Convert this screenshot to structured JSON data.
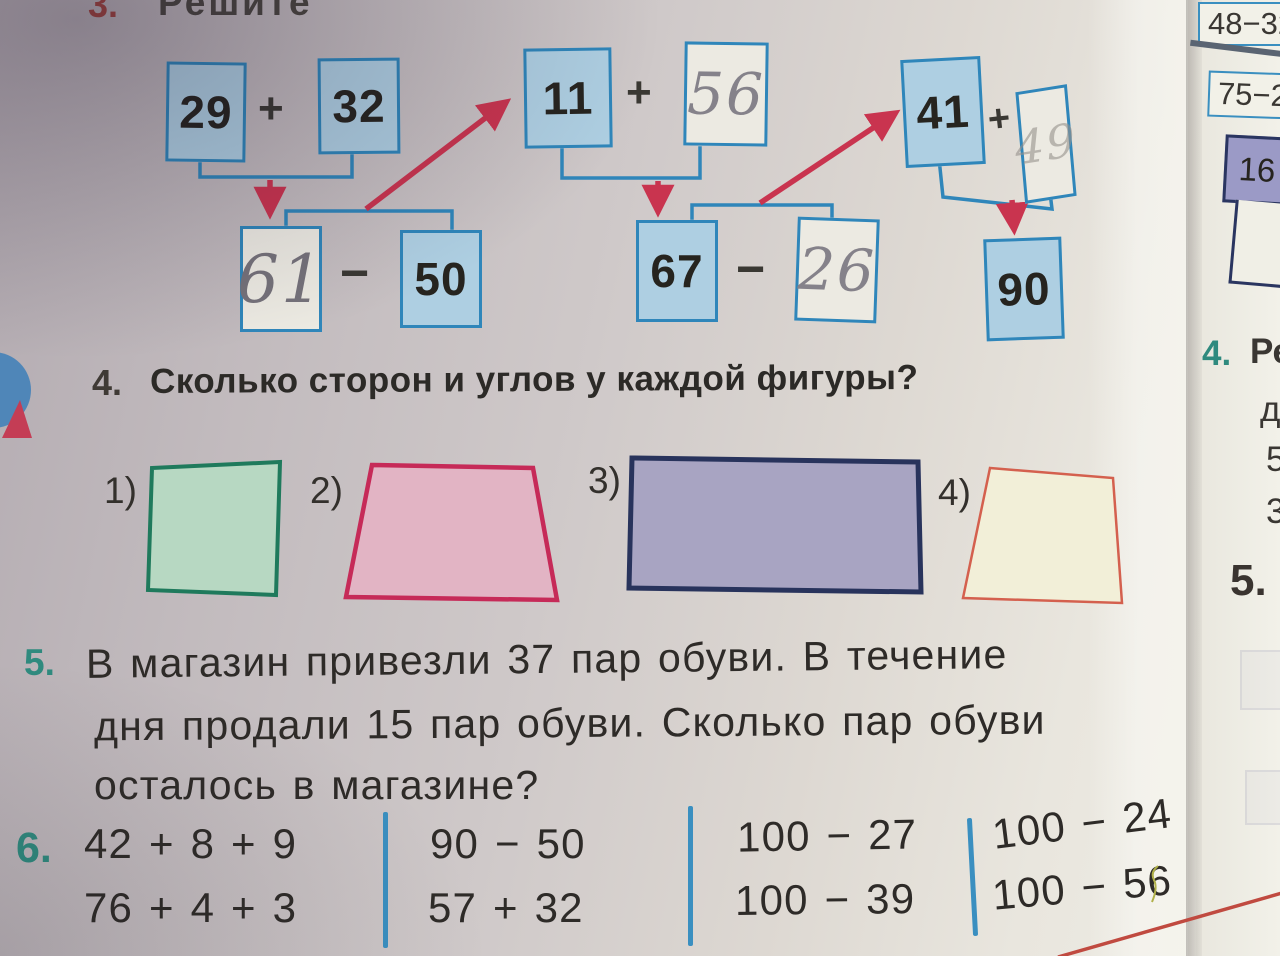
{
  "ex3": {
    "number": "3.",
    "title_fragment": "Решите",
    "boxes": [
      {
        "value": "29",
        "style": "printed"
      },
      {
        "value": "32",
        "style": "printed"
      },
      {
        "value": "61",
        "style": "handwritten"
      },
      {
        "value": "50",
        "style": "printed"
      },
      {
        "value": "11",
        "style": "printed"
      },
      {
        "value": "56",
        "style": "handwritten"
      },
      {
        "value": "67",
        "style": "printed"
      },
      {
        "value": "26",
        "style": "handwritten"
      },
      {
        "value": "41",
        "style": "printed"
      },
      {
        "value": "49",
        "style": "handwritten-faint"
      },
      {
        "value": "90",
        "style": "printed"
      }
    ],
    "operators": [
      "+",
      "−",
      "+",
      "−",
      "+"
    ]
  },
  "ex4": {
    "number": "4.",
    "question": "Сколько сторон и углов у каждой фигуры?",
    "shapes": [
      {
        "label": "1)",
        "kind": "square",
        "fill": "#b7d8c2",
        "stroke": "#1f7a5c"
      },
      {
        "label": "2)",
        "kind": "trapezoid",
        "fill": "#e2b4c4",
        "stroke": "#c62a58"
      },
      {
        "label": "3)",
        "kind": "rectangle",
        "fill": "#a8a4c2",
        "stroke": "#28335c"
      },
      {
        "label": "4)",
        "kind": "trapezoid",
        "fill": "#f2efd8",
        "stroke": "#d4604e"
      }
    ]
  },
  "ex5": {
    "number": "5.",
    "line1": "В магазин привезли 37 пар обуви. В течение",
    "line2": "дня продали 15 пар обуви. Сколько пар обуви",
    "line3": "осталось в магазине?"
  },
  "ex6": {
    "number": "6.",
    "columns": [
      [
        "42 + 8 + 9",
        "76 + 4 + 3"
      ],
      [
        "90 − 50",
        "57 + 32"
      ],
      [
        "100 − 27",
        "100 − 39"
      ],
      [
        "100 − 24",
        "100 − 56"
      ]
    ]
  },
  "right_page": {
    "box1": "48−32",
    "box2": "75−2",
    "table_cell": "16",
    "ex4_number": "4.",
    "ex4_fragment": "Ре",
    "fragment_line2": "д",
    "fragment_line3": "5",
    "fragment_line4": "3",
    "ex5_number": "5."
  },
  "colors": {
    "box_fill": "#aecfe2",
    "box_border": "#2f86ba",
    "arrow_red": "#c9344f",
    "accent_teal": "#2f8a7e",
    "accent_red": "#a04540",
    "divider_blue": "#3a8fc0",
    "red_curve": "#c04a40"
  }
}
